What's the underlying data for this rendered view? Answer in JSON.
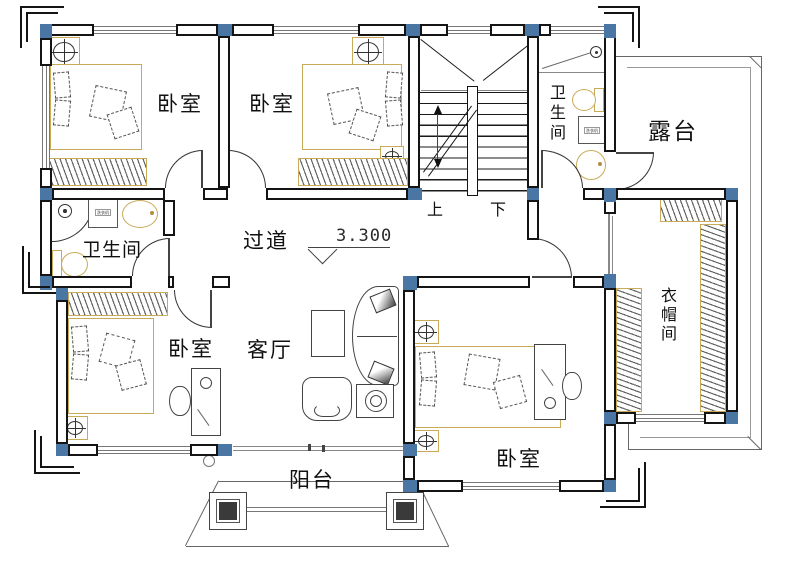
{
  "labels": {
    "bedroom": "卧室",
    "bathroom": "卫生间",
    "terrace": "露台",
    "closet": "衣帽间",
    "corridor": "过道",
    "living": "客厅",
    "balcony": "阳台",
    "up": "上",
    "down": "下",
    "elevation": "3.300",
    "washer": "洗衣机"
  },
  "colors": {
    "wall": "#141414",
    "column": "#4a76a4",
    "wood_fixture": "#c9ab57",
    "porch_post": "#3a3a3a",
    "thin_line": "#666666"
  }
}
